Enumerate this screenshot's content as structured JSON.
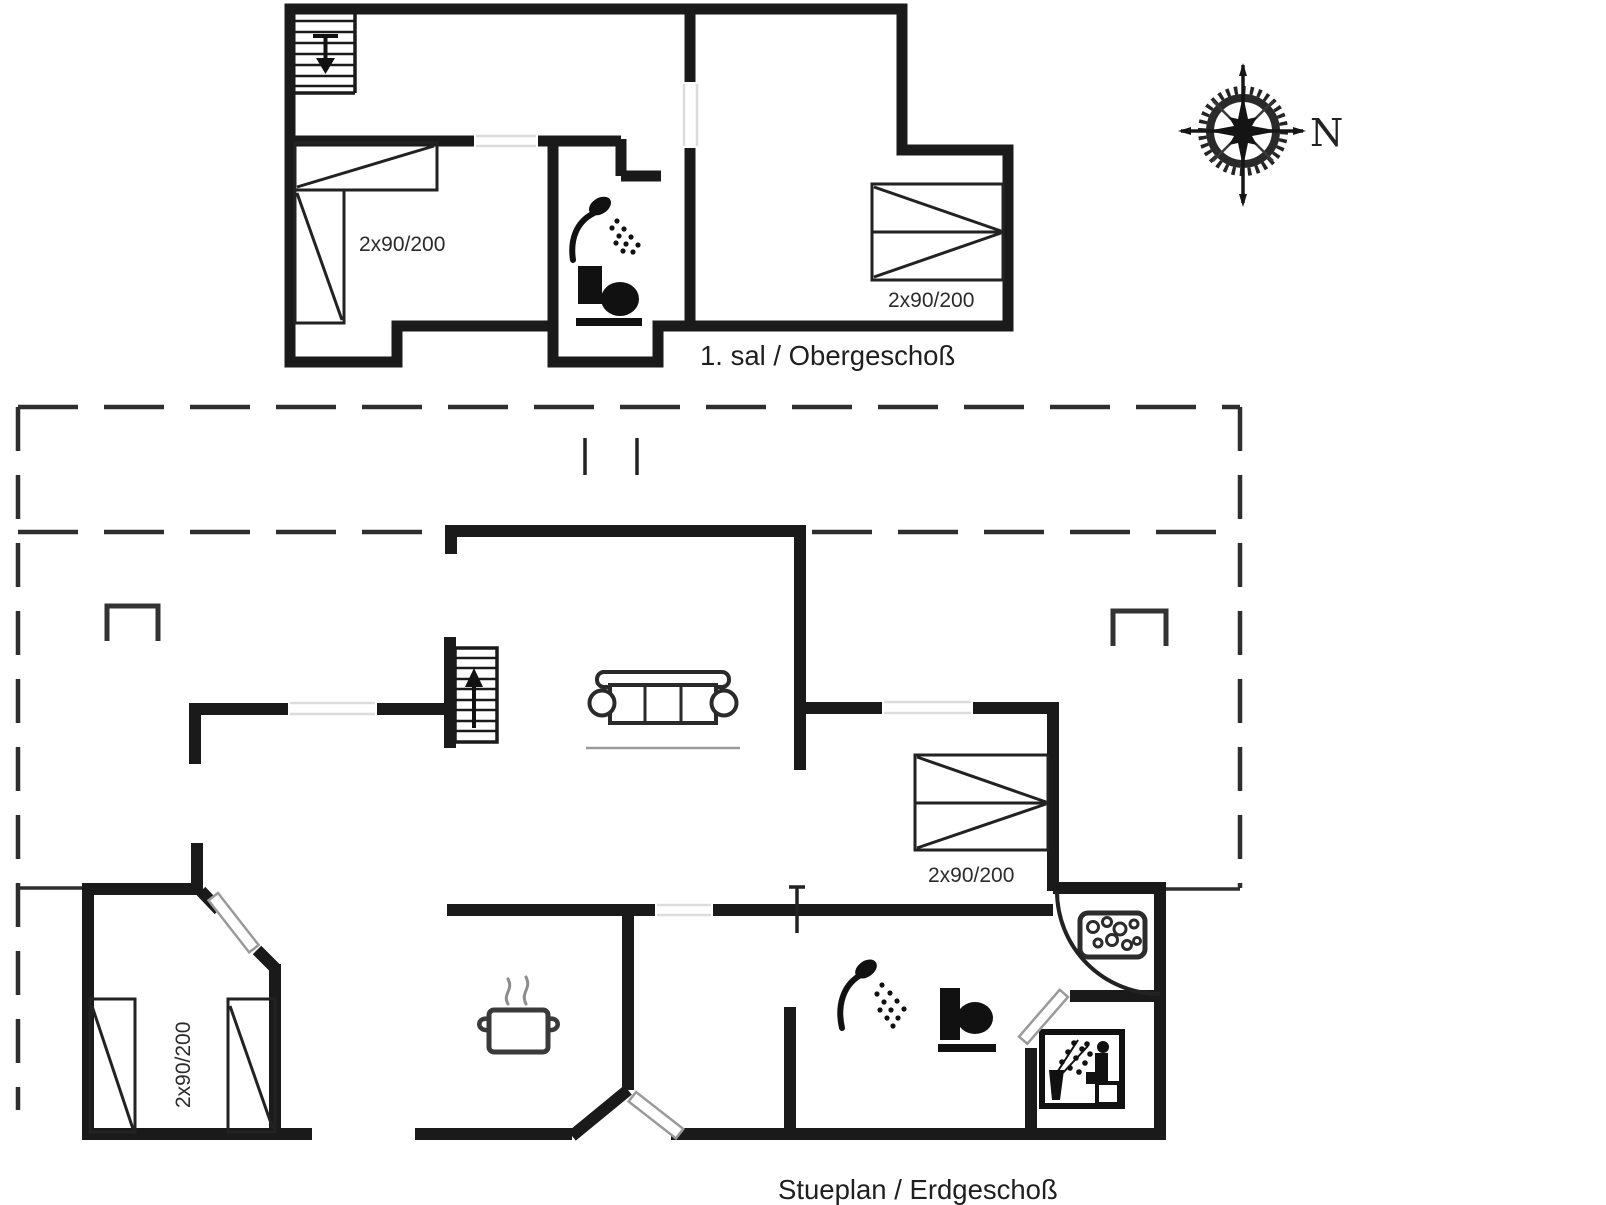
{
  "document": {
    "type": "holiday-home-floor-plan",
    "background_color": "#ffffff",
    "line_color": "#1a1a1a"
  },
  "upper_floor": {
    "label": "1. sal / Obergeschoß",
    "bedroom_left_bed_label": "2x90/200",
    "bedroom_right_bed_label": "2x90/200",
    "icons": [
      "stairs-down-icon",
      "bed-icon",
      "shower-icon",
      "toilet-icon",
      "bed-icon"
    ]
  },
  "ground_floor": {
    "label": "Stueplan / Erdgeschoß",
    "bedroom_left_bed_label": "2x90/200",
    "bedroom_right_bed_label": "2x90/200",
    "icons": [
      "stairs-up-icon",
      "sofa-icon",
      "cooking-pot-icon",
      "shower-icon",
      "toilet-icon",
      "whirlpool-icon",
      "sauna-icon",
      "bed-icon"
    ]
  },
  "compass": {
    "north_label": "N",
    "icon": "compass-rose-icon"
  }
}
